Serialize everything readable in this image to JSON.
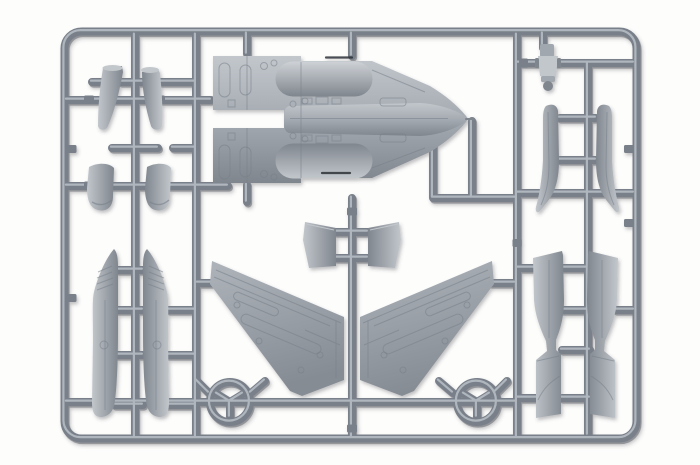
{
  "meta": {
    "subject": "Gray injection-molded plastic model kit sprue with jet aircraft parts",
    "setting": "photographed on a plain white background",
    "plastic_color_name": "medium gray polystyrene"
  },
  "colors": {
    "background": "#fdfdfc",
    "runner": "#79808a",
    "runner_highlight": "#bac0c6",
    "runner_shadow": "#53585f",
    "part_light": "#c2c7cc",
    "part_mid": "#a1a7ae",
    "part_dark": "#80868e",
    "nacelle_hi": "#ced2d6",
    "wing_light": "#aeb4ba",
    "wing_dark": "#868c94",
    "panel_line": "#788089",
    "detail_dark": "#2e3237"
  },
  "shadow": {
    "hex": "#3a3e44",
    "opacity": "0.32"
  },
  "sprue": {
    "frame_shape": "rounded rectangle runner frame",
    "rings": [
      {
        "name": "runner-ring-left"
      },
      {
        "name": "runner-ring-right"
      }
    ]
  },
  "parts": [
    {
      "id": "fuselage-part",
      "label": "fuselage with twin engine nacelles and long nose cone",
      "count": 1,
      "location": "top center"
    },
    {
      "id": "wing-left-part",
      "label": "left swept wing panel with engraved panel lines",
      "count": 1,
      "location": "bottom center-left"
    },
    {
      "id": "wing-right-part",
      "label": "right swept wing panel with engraved panel lines",
      "count": 1,
      "location": "bottom center-right"
    },
    {
      "id": "small-duct-parts",
      "label": "small angled duct / nozzle fairings",
      "count": 2,
      "location": "top left"
    },
    {
      "id": "intake-lip-parts",
      "label": "small curved intake lip pieces",
      "count": 2,
      "location": "middle left"
    },
    {
      "id": "long-fairing-parts",
      "label": "long pointed fairing / gear door pieces with textured tips",
      "count": 2,
      "location": "bottom left"
    },
    {
      "id": "small-fin-parts",
      "label": "small trapezoid fin pieces",
      "count": 2,
      "location": "center between wings"
    },
    {
      "id": "ejection-seat-part",
      "label": "ejection seat",
      "count": 1,
      "location": "top right"
    },
    {
      "id": "fin-blade-parts",
      "label": "curved fin blade pieces with flared feet",
      "count": 2,
      "location": "upper right"
    },
    {
      "id": "intake-trunk-parts",
      "label": "long intake trunk / exhaust duct pieces",
      "count": 2,
      "location": "lower right"
    }
  ]
}
